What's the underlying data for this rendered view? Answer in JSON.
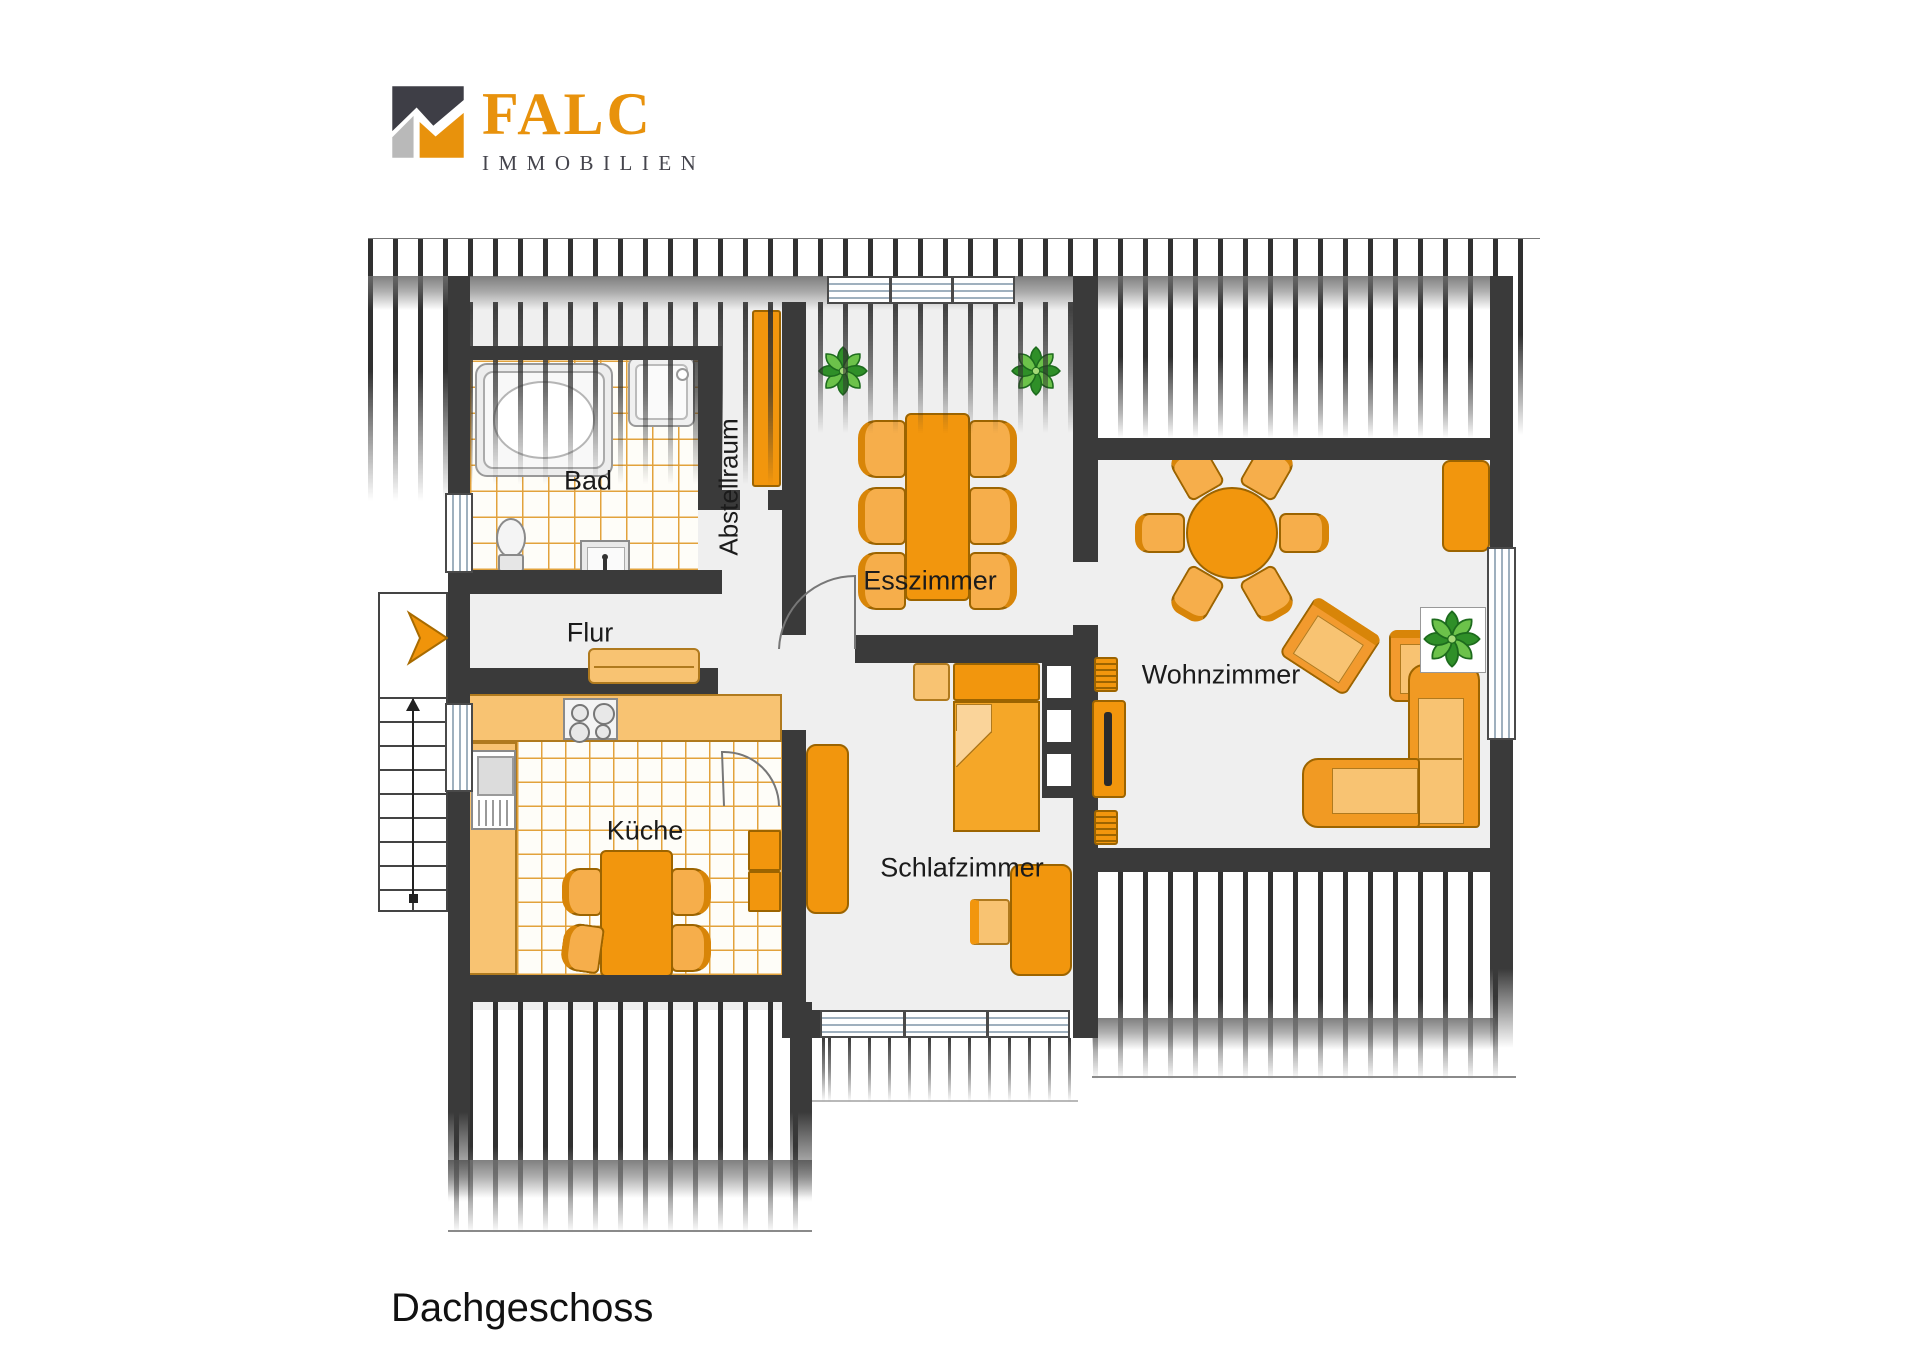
{
  "brand": {
    "name": "FALC",
    "subtitle": "IMMOBILIEN"
  },
  "floor_label": "Dachgeschoss",
  "rooms": {
    "bad": {
      "label": "Bad"
    },
    "flur": {
      "label": "Flur"
    },
    "abstellraum": {
      "label": "Abstellraum"
    },
    "esszimmer": {
      "label": "Esszimmer"
    },
    "kueche": {
      "label": "Küche"
    },
    "schlafzimmer": {
      "label": "Schlafzimmer"
    },
    "wohnzimmer": {
      "label": "Wohnzimmer"
    }
  },
  "colors": {
    "brand_orange": "#E8920C",
    "brand_gray": "#45454D",
    "wall": "#3A3A3A",
    "room_background": "#EFEFEF",
    "furniture_orange": "#F2960D",
    "furniture_light_orange": "#F8C372",
    "tile_grout_orange": "#E2A23C",
    "plant_green": "#3E9B2E",
    "window_glass": "#9FB0BE"
  }
}
